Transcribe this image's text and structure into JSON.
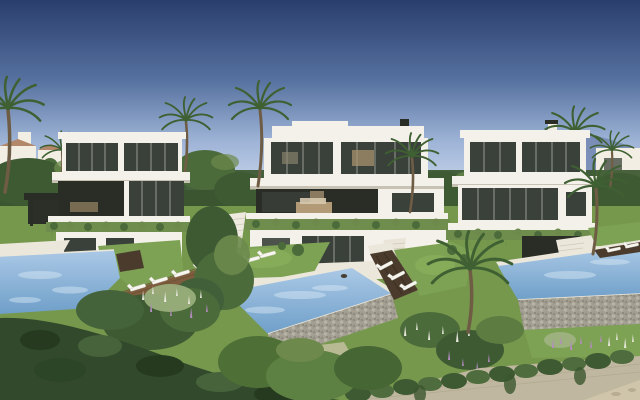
{
  "meta": {
    "type": "architectural-rendering",
    "description": "Photorealistic render of three modern white flat-roof luxury villas on a terraced hillside under a clear blue sky. Each villa has full-height glazing, cantilevered slabs and planted balcony edges. In front of the villas are lawns with white sun loungers, three infinity pools over gabion stone walls, a wooden deck, palm trees, sage and flowering shrubs, and an ivy-covered stone retaining wall with a sandy path at the bottom right. Distant low-rise buildings and a hazy blue mountain sit on the horizon."
  },
  "palette": {
    "sky_top": "#2a3e6d",
    "sky_mid": "#56719f",
    "sky_low": "#9db3d6",
    "sky_horizon": "#c9d6ec",
    "mountain": "#7589b4",
    "building_white": "#f2eee4",
    "roof_terracotta": "#b3876a",
    "villa_white": "#f4f1ea",
    "slab_shadow": "#c8c2b4",
    "glass_dark": "#39413a",
    "soffit_dark": "#2a2d26",
    "plant_green": "#6f8d4d",
    "lawn_green": "#7da254",
    "lawn_light": "#8db25e",
    "ground_green": "#76984d",
    "canopy_dark": "#3e5a33",
    "canopy_mid": "#4c6b3b",
    "canopy_light": "#6d8a4c",
    "palm_green": "#3f6032",
    "trunk_brown": "#6f5c44",
    "pool_light": "#abc9e6",
    "pool_deep": "#6f9fc9",
    "coping_white": "#ece7db",
    "stone_gabion": "#a3a093",
    "stone_wall": "#c0b7a0",
    "wood_deck": "#7e5d3e",
    "timber_dark": "#4a3b2c",
    "hedge_dark": "#33492b",
    "sage": "#9cb17e",
    "flower_purple": "#b48cc0",
    "flower_white": "#e9e8dd",
    "sand": "#cfc5ab",
    "lounger_white": "#f7f6f1"
  },
  "scene": {
    "sky": {
      "condition": "clear",
      "gradient": "dark navy at top fading to pale blue at the horizon"
    },
    "background": {
      "left": "distant low-rise white buildings with terracotta roofs among trees",
      "right": "white houses with a chimney and a hazy blue mountain ridge",
      "mid": "dense green tree canopy with scattered palm trees"
    },
    "villas": [
      {
        "id": "villa-left",
        "position": "left",
        "stories": 3,
        "style": "modern white flat roof, cantilevered slabs, full-height dark glazing",
        "features": [
          "dark carport pergola",
          "planted terrace edge",
          "garden-level suite"
        ]
      },
      {
        "id": "villa-center",
        "position": "center",
        "stories": 3,
        "style": "modern white flat roof with deep covered terrace and warm interior",
        "features": [
          "hanging gardens on balcony edge",
          "white side staircase",
          "glass garden level",
          "terrace furniture"
        ]
      },
      {
        "id": "villa-right",
        "position": "right",
        "stories": 3,
        "style": "modern white flat roof with glass curtain wall",
        "features": [
          "roof chimney behind",
          "planted terrace edge",
          "curved white garden terrace"
        ]
      }
    ],
    "pools": [
      {
        "id": "pool-left",
        "type": "infinity",
        "water": "light blue",
        "features": [
          "white coping",
          "diagonal wooden deck",
          "4 white sun loungers"
        ]
      },
      {
        "id": "pool-center",
        "type": "infinity over gabion stone wall",
        "water": "light blue",
        "features": [
          "angled plan",
          "swimmer in water",
          "timber deck with 3 loungers at right"
        ]
      },
      {
        "id": "pool-right",
        "type": "infinity over gabion stone wall",
        "water": "light blue",
        "features": [
          "dark timber deck with 2 loungers",
          "flower bed lawn below"
        ]
      }
    ],
    "gardens": {
      "lawns": 4,
      "palms": 10,
      "shrubs": "rounded green and sage shrubs on terraced slopes",
      "flowers": "white and purple flower spikes",
      "walls": "gabion pool walls and an ivy-draped stone retaining wall across the foreground",
      "path": "sandy gravel path at lower right corner"
    },
    "furniture": {
      "sun_loungers": {
        "count": 11,
        "color": "white",
        "locations": [
          "left wooden deck",
          "central lawn",
          "timber deck beside central pool",
          "deck above right pool"
        ]
      }
    }
  }
}
